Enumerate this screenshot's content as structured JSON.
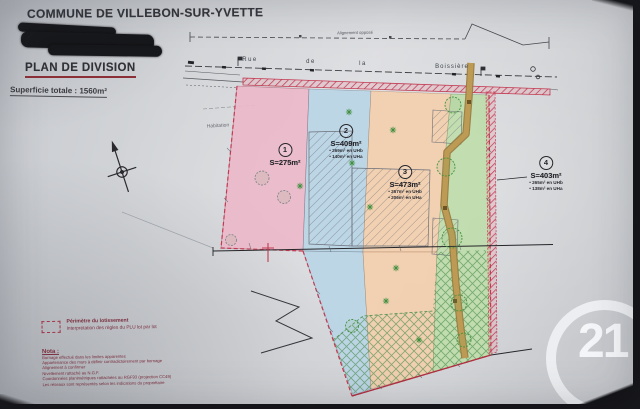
{
  "header": {
    "commune": "COMMUNE DE VILLEBON-SUR-YVETTE",
    "plan_title": "PLAN DE DIVISION",
    "total_area_label": "Superficie totale : 1560m²"
  },
  "street": {
    "alignment_label": "Alignement opposé",
    "name_word_1": "Rue",
    "name_word_2": "de",
    "name_word_3": "la",
    "name_word_4": "Boissière"
  },
  "annotations": {
    "habitation": "Habitation"
  },
  "parcels": [
    {
      "num": "1",
      "area": "S=275m²"
    },
    {
      "num": "2",
      "area": "S=409m²",
      "details": [
        "• 269m² en UHb",
        "• 140m² en UHa"
      ]
    },
    {
      "num": "3",
      "area": "S=473m²",
      "details": [
        "• 267m² en UHb",
        "• 206m² en UHa"
      ]
    },
    {
      "num": "4",
      "area": "S=403m²",
      "details": [
        "• 265m² en UHb",
        "• 138m² en UHa"
      ]
    }
  ],
  "legend": {
    "perimeter_label": "Périmètre du lotissement",
    "perimeter_sub": "Interprétation des règles du PLU lot par lot",
    "nota_title": "Nota :",
    "notes": [
      "Bornage effectué dans les limites apparentes",
      "Appartenance des murs à définir contradictoirement par bornage",
      "Alignement à confirmer",
      "Nivellement rattaché au N.G.F.",
      "Coordonnées planimétriques rattachées au RGF93 (projection CC49)",
      "Les réseaux sont représentés selon les indications du propriétaire"
    ]
  },
  "watermark": {
    "text": "21"
  },
  "colors": {
    "parcel1_pink": "#ecb9c9",
    "parcel2_blue": "#b9d5e6",
    "parcel3_orange": "#f3cfae",
    "parcel4_green": "#bfdcab",
    "perimeter_red": "#c23a52",
    "path_brown": "#b08948",
    "legend_maroon": "#7a2e3e"
  }
}
